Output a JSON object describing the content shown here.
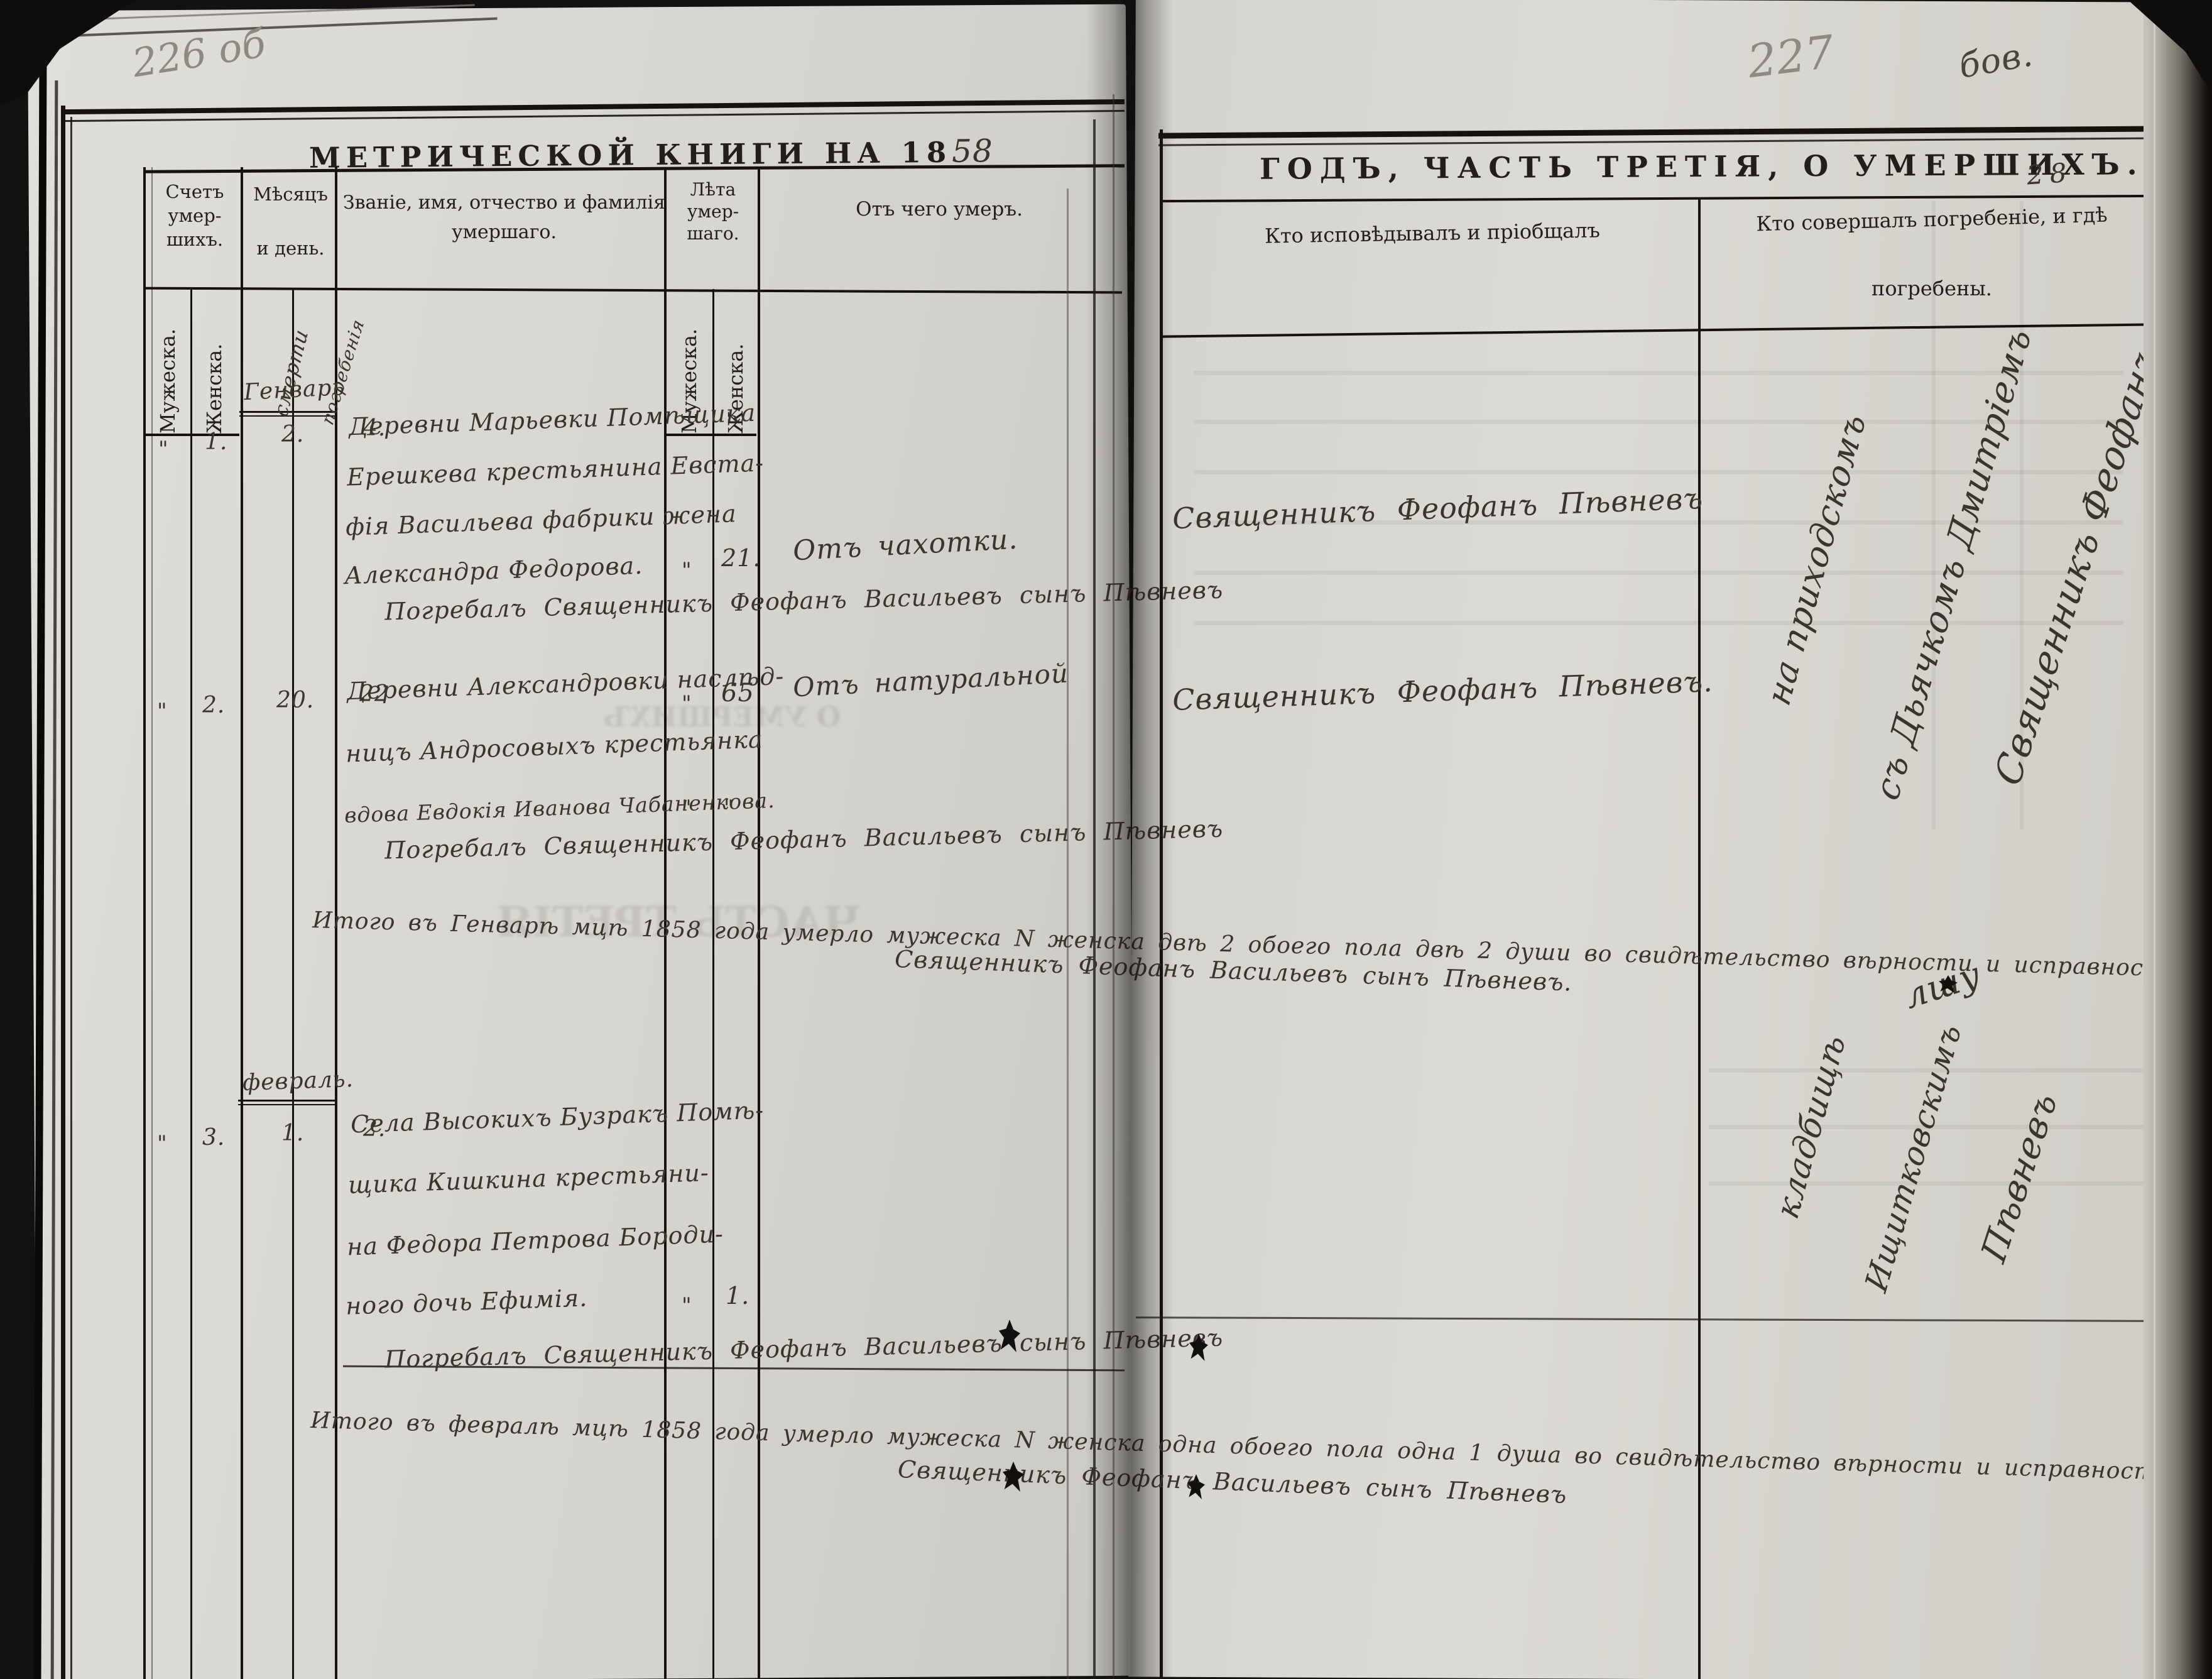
{
  "scan": {
    "left_folio": "226 об",
    "right_folio": "227",
    "right_scribble": "бов.",
    "right_page_num": "28",
    "spine_scribble": "лшу"
  },
  "left_page": {
    "title_printed": "МЕТРИЧЕСКОЙ КНИГИ НА 18",
    "title_year_hand": "58",
    "columns": {
      "count": {
        "title_lines": [
          "Счетъ",
          "умер-",
          "шихъ."
        ],
        "male": "Мужеска.",
        "female": "Женска."
      },
      "date": {
        "title_lines": [
          "Мѣсяцъ",
          "и день."
        ],
        "sub_death": "смерти",
        "sub_burial": "погребенія"
      },
      "name": {
        "title_lines": [
          "Званіе, имя, отчество и фамилія",
          "умершаго."
        ]
      },
      "age": {
        "title_lines": [
          "Лѣта",
          "умер-",
          "шаго."
        ],
        "male": "Мужеска.",
        "female": "Женска."
      },
      "cause": {
        "title": "Отъ чего умеръ."
      }
    },
    "months": {
      "january": "Генварь",
      "february": "февраль."
    },
    "records": [
      {
        "count_male": "\"",
        "count_female": "1.",
        "death_day": "2.",
        "burial_day": "4.",
        "name_lines": [
          "Деревни Марьевки Помѣщика",
          "Ерешкева крестьянина Евста-",
          "фія Васильева фабрики жена",
          "Александра Федорова."
        ],
        "age_male": "\"",
        "age_female": "21.",
        "cause": "Отъ чахотки.",
        "burial_note": "Погребалъ  Священникъ Феофанъ Васильевъ сынъ Пѣвневъ"
      },
      {
        "count_male": "\"",
        "count_female": "2.",
        "death_day": "20.",
        "burial_day": "22",
        "name_lines": [
          "Деревни Александровки наслѣд-",
          "ницъ Андросовыхъ крестьянка",
          "вдова Евдокія Иванова Чабаненкова."
        ],
        "age_male": "\"",
        "age_female": "65",
        "ditto_male": "\"",
        "ditto_female": "\"",
        "cause": "Отъ натуральной",
        "burial_note": "Погребалъ  Священникъ Феофанъ Васильевъ сынъ Пѣвневъ"
      },
      {
        "count_male": "\"",
        "count_female": "3.",
        "death_day": "1.",
        "burial_day": "2.",
        "name_lines": [
          "Села Высокихъ Бузракъ Помѣ-",
          "щика Кишкина крестьяни-",
          "на Федора Петрова Бороди-",
          "ного дочь Ефимія."
        ],
        "age_male": "\"",
        "age_female": "1.",
        "cause": "",
        "burial_note": "Погребалъ  Священникъ Феофанъ Васильевъ сынъ Пѣвневъ"
      }
    ],
    "summaries": {
      "january": {
        "line": "Итого въ Генварѣ мцѣ 1858 года умерло мужеска N женска двѣ 2 обоего пола двѣ 2 души во свидѣтельство вѣрности и исправности подписуемся.",
        "signature": "Священникъ Феофанъ Васильевъ сынъ Пѣвневъ."
      },
      "february": {
        "line": "Итого въ февралѣ мцѣ 1858 года умерло мужеска N женска одна обоего пола одна 1 душа во свидѣтельство вѣрности и исправности подписуемся.",
        "signature": "Священникъ Феофанъ Васильевъ сынъ Пѣвневъ"
      }
    },
    "bleed_ghosts": [
      "ЧАСТЬ ТРЕТІЯ",
      "О УМЕРШИХЪ"
    ]
  },
  "right_page": {
    "title": "ГОДЪ, ЧАСТЬ ТРЕТІЯ, О УМЕРШИХЪ.",
    "columns": {
      "confessed": "Кто исповѣдывалъ и пріобщалъ",
      "burial_lines": [
        "Кто совершалъ погребеніе, и гдѣ",
        "погребены."
      ]
    },
    "entries": [
      "Священникъ Феофанъ Пѣвневъ",
      "Священникъ Феофанъ Пѣвневъ."
    ],
    "diagonal_january": [
      "на приходскомъ",
      "съ Дьячкомъ Дмитріемъ",
      "Священникъ Феофанъ"
    ],
    "diagonal_february": [
      "кладбищѣ",
      "Ищитковскимъ",
      "Пѣвневъ"
    ]
  }
}
